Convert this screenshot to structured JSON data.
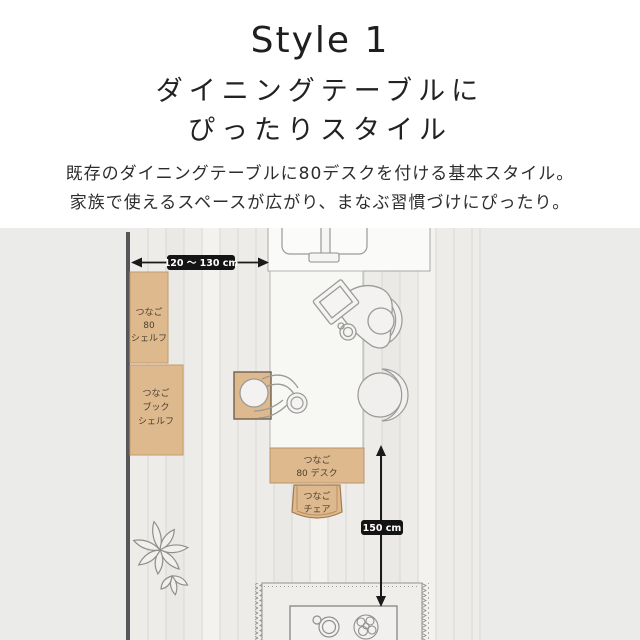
{
  "page": {
    "title": "Style 1",
    "heading_line1": "ダイニングテーブルに",
    "heading_line2": "ぴったりスタイル",
    "desc_line1": "既存のダイニングテーブルに80デスクを付ける基本スタイル。",
    "desc_line2": "家族で使えるスペースが広がり、まなぶ習慣づけにぴったり。"
  },
  "diagram": {
    "width_measure": "120 〜 130 cm",
    "height_measure": "150 cm",
    "shelf80": {
      "line1": "つなご",
      "line2": "80",
      "line3": "シェルフ"
    },
    "bookshelf": {
      "line1": "つなご",
      "line2": "ブック",
      "line3": "シェルフ"
    },
    "desk": {
      "line1": "つなご",
      "line2": "80 デスク"
    },
    "chair": {
      "line1": "つなご",
      "line2": "チェア"
    },
    "colors": {
      "furniture_tan": "#dfb98e",
      "measure_badge_bg": "#141414",
      "floor_bg": "#edece9",
      "wall": "#56565a",
      "line_art": "#8f8f8d"
    }
  }
}
